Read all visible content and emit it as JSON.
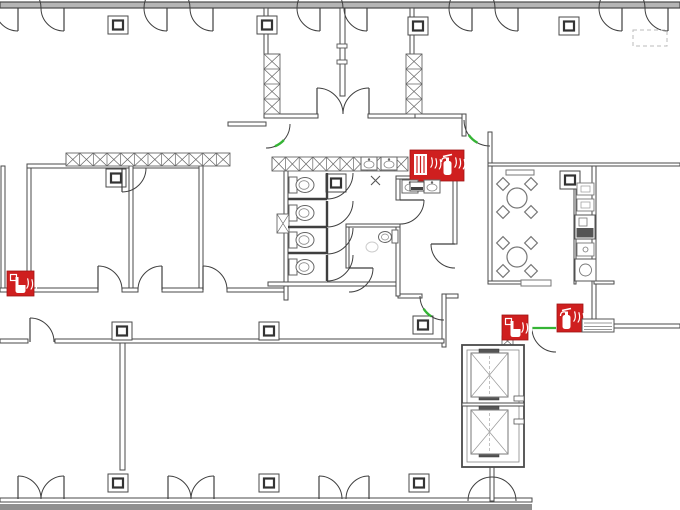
{
  "meta": {
    "drawing_type": "fire-safety-evacuation-floor-plan",
    "canvas": {
      "w": 680,
      "h": 510
    }
  },
  "palette": {
    "wall_stroke": "#4a4a4a",
    "wall_ext_fill": "#b5b5b5",
    "wall_band_fill": "#8f8f8f",
    "thin_fill": "#ffffff",
    "fixture_stroke": "#777777",
    "light_stroke": "#bbbbbb",
    "ghost_stroke": "#cccccc",
    "door_stroke": "#3f3f3f",
    "fire_red": "#cf1f1f",
    "exit_green": "#35b435",
    "dark_fill": "#555555",
    "white": "#ffffff"
  },
  "walls": {
    "exterior": [
      {
        "n": "top-exterior-wall",
        "x": 0,
        "y": 2,
        "w": 680,
        "h": 6,
        "t": "ext"
      },
      {
        "n": "bottom-exterior-wall",
        "x": 0,
        "y": 498,
        "w": 532,
        "h": 4,
        "t": "thin"
      },
      {
        "n": "bottom-exterior-band",
        "x": 0,
        "y": 504,
        "w": 532,
        "h": 6,
        "t": "band"
      }
    ],
    "interior": [
      {
        "n": "left-shaft-west-wall",
        "x": 1,
        "y": 166,
        "w": 4,
        "h": 126
      },
      {
        "n": "left-shaft-east-wall",
        "x": 27,
        "y": 166,
        "w": 4,
        "h": 126
      },
      {
        "n": "rooms-top-wall",
        "x": 27,
        "y": 164,
        "w": 176,
        "h": 4
      },
      {
        "n": "room-divider-a-b",
        "x": 129,
        "y": 166,
        "w": 4,
        "h": 124
      },
      {
        "n": "room-divider-b-bay",
        "x": 199,
        "y": 166,
        "w": 4,
        "h": 124
      },
      {
        "n": "corridor-top-wall-1",
        "x": 0,
        "y": 288,
        "w": 98,
        "h": 4
      },
      {
        "n": "corridor-top-wall-2",
        "x": 122,
        "y": 288,
        "w": 16,
        "h": 4
      },
      {
        "n": "corridor-top-wall-3",
        "x": 162,
        "y": 288,
        "w": 41,
        "h": 4
      },
      {
        "n": "corridor-top-wall-4",
        "x": 227,
        "y": 288,
        "w": 60,
        "h": 4
      },
      {
        "n": "vestibule-left-wall-top",
        "x": 264,
        "y": 8,
        "w": 4,
        "h": 46
      },
      {
        "n": "vestibule-mid-wall",
        "x": 340,
        "y": 8,
        "w": 5,
        "h": 88
      },
      {
        "n": "vestibule-right-wall-top",
        "x": 410,
        "y": 8,
        "w": 4,
        "h": 46
      },
      {
        "n": "vestibule-bottom-wall-left",
        "x": 264,
        "y": 114,
        "w": 54,
        "h": 4
      },
      {
        "n": "vestibule-bottom-wall-right",
        "x": 368,
        "y": 114,
        "w": 47,
        "h": 4
      },
      {
        "n": "hall-wall-y114",
        "x": 415,
        "y": 114,
        "w": 51,
        "h": 4
      },
      {
        "n": "hall-corner-wall",
        "x": 462,
        "y": 114,
        "w": 4,
        "h": 22
      },
      {
        "n": "breakroom-entry-wall",
        "x": 488,
        "y": 132,
        "w": 4,
        "h": 34
      },
      {
        "n": "right-wing-top-wall",
        "x": 488,
        "y": 163,
        "w": 192,
        "h": 3
      },
      {
        "n": "breakroom-left-wall",
        "x": 488,
        "y": 166,
        "w": 4,
        "h": 118
      },
      {
        "n": "breakroom-bottom-wall",
        "x": 488,
        "y": 281,
        "w": 60,
        "h": 3
      },
      {
        "n": "kitchen-right-wall",
        "x": 592,
        "y": 166,
        "w": 4,
        "h": 158
      },
      {
        "n": "kitchen-bottom-wall",
        "x": 594,
        "y": 281,
        "w": 20,
        "h": 3
      },
      {
        "n": "right-lobby-wall",
        "x": 614,
        "y": 324,
        "w": 66,
        "h": 4
      },
      {
        "n": "left-vestibule-west-wall",
        "x": 228,
        "y": 122,
        "w": 38,
        "h": 4
      },
      {
        "n": "toilet-left-wall",
        "x": 284,
        "y": 167,
        "w": 4,
        "h": 133
      },
      {
        "n": "toilet-bottom-wall-left",
        "x": 268,
        "y": 282,
        "w": 130,
        "h": 4
      },
      {
        "n": "toilet-bottom-wall-mid",
        "x": 398,
        "y": 294,
        "w": 24,
        "h": 4
      },
      {
        "n": "toilet-bottom-wall-right",
        "x": 444,
        "y": 294,
        "w": 14,
        "h": 4
      },
      {
        "n": "washroom-top-wall",
        "x": 396,
        "y": 176,
        "w": 62,
        "h": 3
      },
      {
        "n": "washroom-left-wall-upper",
        "x": 396,
        "y": 179,
        "w": 4,
        "h": 21
      },
      {
        "n": "washroom-left-wall-lower",
        "x": 396,
        "y": 224,
        "w": 4,
        "h": 72
      },
      {
        "n": "wc-room-top-wall",
        "x": 346,
        "y": 224,
        "w": 54,
        "h": 3
      },
      {
        "n": "wc-room-left-wall",
        "x": 346,
        "y": 227,
        "w": 3,
        "h": 41
      },
      {
        "n": "washroom-right-wall",
        "x": 453,
        "y": 176,
        "w": 4,
        "h": 68
      },
      {
        "n": "elevator-lobby-left-wall",
        "x": 442,
        "y": 294,
        "w": 4,
        "h": 53
      },
      {
        "n": "corridor-bottom-wall-1",
        "x": 0,
        "y": 339,
        "w": 28,
        "h": 4
      },
      {
        "n": "corridor-bottom-wall-2",
        "x": 55,
        "y": 339,
        "w": 389,
        "h": 4
      },
      {
        "n": "office-partition-wall",
        "x": 120,
        "y": 343,
        "w": 5,
        "h": 127
      },
      {
        "n": "below-shaft-wall",
        "x": 490,
        "y": 465,
        "w": 4,
        "h": 36
      },
      {
        "n": "kitchen-counter-edge",
        "x": 574,
        "y": 178,
        "w": 2,
        "h": 106
      }
    ]
  },
  "elevator": {
    "outer": {
      "x": 462,
      "y": 345,
      "w": 62,
      "h": 122
    },
    "inner": {
      "x": 467,
      "y": 350,
      "w": 52,
      "h": 112
    },
    "divider": {
      "x": 462,
      "y": 403,
      "w": 62,
      "h": 3
    },
    "cars": [
      {
        "x": 471,
        "y": 353,
        "w": 37,
        "h": 44
      },
      {
        "x": 471,
        "y": 410,
        "w": 37,
        "h": 44
      }
    ],
    "mechs": [
      [
        479,
        349,
        20,
        5
      ],
      [
        479,
        395,
        20,
        5
      ],
      [
        479,
        406,
        20,
        5
      ],
      [
        479,
        452,
        20,
        5
      ]
    ],
    "jambs": [
      [
        514,
        396,
        10,
        5
      ],
      [
        514,
        419,
        10,
        5
      ]
    ]
  },
  "hatches": [
    {
      "n": "hatched-wall-left",
      "x": 66,
      "y": 153,
      "w": 164,
      "h": 13,
      "o": "h"
    },
    {
      "n": "hatched-wall-toilet",
      "x": 272,
      "y": 157,
      "w": 136,
      "h": 14,
      "o": "h"
    },
    {
      "n": "hatched-wall-vestibule-left",
      "x": 264,
      "y": 54,
      "w": 16,
      "h": 60,
      "o": "v"
    },
    {
      "n": "hatched-wall-vestibule-right",
      "x": 406,
      "y": 54,
      "w": 16,
      "h": 60,
      "o": "v"
    },
    {
      "n": "hatched-wall-stall",
      "x": 277,
      "y": 214,
      "w": 12,
      "h": 19,
      "o": "v"
    },
    {
      "n": "hatched-wall-lobby-stub",
      "x": 502,
      "y": 336,
      "w": 11,
      "h": 10,
      "o": "v"
    }
  ],
  "columns": [
    [
      118,
      25
    ],
    [
      267,
      25
    ],
    [
      418,
      26
    ],
    [
      569,
      26
    ],
    [
      116,
      178
    ],
    [
      336,
      183
    ],
    [
      570,
      180
    ],
    [
      122,
      331
    ],
    [
      269,
      331
    ],
    [
      423,
      325
    ],
    [
      118,
      483
    ],
    [
      269,
      483
    ],
    [
      419,
      483
    ]
  ],
  "doors": [
    {
      "n": "door-top-1-left",
      "c": [
        18,
        8
      ],
      "r": 23,
      "a1": 90,
      "a2": 360,
      "leaf": true
    },
    {
      "n": "door-top-1-right",
      "c": [
        64,
        8
      ],
      "r": 23,
      "a1": 90,
      "a2": 180,
      "leaf": true
    },
    {
      "n": "door-top-2-left",
      "c": [
        167,
        8
      ],
      "r": 23,
      "a1": 90,
      "a2": 360,
      "leaf": true
    },
    {
      "n": "door-top-2-right",
      "c": [
        213,
        8
      ],
      "r": 23,
      "a1": 90,
      "a2": 180,
      "leaf": true
    },
    {
      "n": "door-top-3-left",
      "c": [
        320,
        8
      ],
      "r": 23,
      "a1": 90,
      "a2": 360,
      "leaf": true
    },
    {
      "n": "door-top-3-right",
      "c": [
        367,
        8
      ],
      "r": 23,
      "a1": 90,
      "a2": 180,
      "leaf": true
    },
    {
      "n": "door-top-4-left",
      "c": [
        472,
        8
      ],
      "r": 23,
      "a1": 90,
      "a2": 360,
      "leaf": true
    },
    {
      "n": "door-top-4-right",
      "c": [
        518,
        8
      ],
      "r": 23,
      "a1": 90,
      "a2": 180,
      "leaf": true
    },
    {
      "n": "door-top-5-left",
      "c": [
        622,
        8
      ],
      "r": 23,
      "a1": 90,
      "a2": 360,
      "leaf": true
    },
    {
      "n": "door-top-5-right",
      "c": [
        668,
        8
      ],
      "r": 23,
      "a1": 90,
      "a2": 180,
      "leaf": true
    },
    {
      "n": "door-room-a-top",
      "c": [
        122,
        168
      ],
      "r": 24,
      "a1": 90,
      "a2": 0,
      "leaf": true
    },
    {
      "n": "door-room-a",
      "c": [
        98,
        290
      ],
      "r": 24,
      "a1": 270,
      "a2": 360,
      "leaf": true
    },
    {
      "n": "door-room-b",
      "c": [
        162,
        290
      ],
      "r": 24,
      "a1": 270,
      "a2": 180,
      "leaf": true
    },
    {
      "n": "door-bay",
      "c": [
        203,
        290
      ],
      "r": 24,
      "a1": 270,
      "a2": 360,
      "leaf": true
    },
    {
      "n": "door-corridor-office",
      "c": [
        30,
        342
      ],
      "r": 24,
      "a1": 270,
      "a2": 360,
      "leaf": true
    },
    {
      "n": "door-vestibule-left-leaf",
      "c": [
        317,
        114
      ],
      "r": 26,
      "a1": 270,
      "a2": 360,
      "leaf": true
    },
    {
      "n": "door-vestibule-right-leaf",
      "c": [
        369,
        114
      ],
      "r": 26,
      "a1": 270,
      "a2": 180,
      "leaf": true
    },
    {
      "n": "door-stall-1",
      "c": [
        327,
        173
      ],
      "r": 26,
      "a1": 90,
      "a2": 0,
      "leaf": true,
      "thick": true
    },
    {
      "n": "door-stall-2",
      "c": [
        327,
        201
      ],
      "r": 26,
      "a1": 90,
      "a2": 0,
      "leaf": true,
      "thick": true
    },
    {
      "n": "door-stall-3",
      "c": [
        327,
        228
      ],
      "r": 26,
      "a1": 90,
      "a2": 0,
      "leaf": true,
      "thick": true
    },
    {
      "n": "door-stall-4",
      "c": [
        327,
        255
      ],
      "r": 26,
      "a1": 90,
      "a2": 0,
      "leaf": true,
      "thick": true
    },
    {
      "n": "door-washroom",
      "c": [
        400,
        200
      ],
      "r": 24,
      "a1": 0,
      "a2": 90,
      "leaf": true
    },
    {
      "n": "door-wc-room",
      "c": [
        349,
        268
      ],
      "r": 24,
      "a1": 0,
      "a2": 90,
      "leaf": true
    },
    {
      "n": "door-washroom-right",
      "c": [
        455,
        244
      ],
      "r": 24,
      "a1": 180,
      "a2": 90,
      "leaf": true
    },
    {
      "n": "exit-door-left-vestibule",
      "c": [
        266,
        124
      ],
      "r": 24,
      "a1": 0,
      "a2": 90,
      "green": "tip",
      "tip": 55
    },
    {
      "n": "exit-door-breakroom-entry",
      "c": [
        490,
        120
      ],
      "r": 26,
      "a1": 90,
      "a2": 180,
      "green": "tip",
      "tip": 132
    },
    {
      "n": "exit-door-toilet-corridor",
      "c": [
        444,
        296
      ],
      "r": 24,
      "a1": 90,
      "a2": 180,
      "green": "tip",
      "tip": 135
    },
    {
      "n": "exit-door-elevator-lobby",
      "c": [
        556,
        328
      ],
      "r": 24,
      "a1": 180,
      "a2": 90,
      "leaf": true,
      "green": "leaf"
    },
    {
      "n": "door-shaft-exit",
      "c": [
        492,
        501
      ],
      "r": 24,
      "a1": 180,
      "a2": 360
    },
    {
      "n": "door-bottom-1-left",
      "c": [
        18,
        499
      ],
      "r": 23,
      "a1": 270,
      "a2": 360,
      "leaf": true
    },
    {
      "n": "door-bottom-1-right",
      "c": [
        64,
        499
      ],
      "r": 23,
      "a1": 270,
      "a2": 180,
      "leaf": true
    },
    {
      "n": "door-bottom-2-left",
      "c": [
        168,
        499
      ],
      "r": 23,
      "a1": 270,
      "a2": 360,
      "leaf": true
    },
    {
      "n": "door-bottom-2-right",
      "c": [
        214,
        499
      ],
      "r": 23,
      "a1": 270,
      "a2": 180,
      "leaf": true
    },
    {
      "n": "door-bottom-3-left",
      "c": [
        319,
        499
      ],
      "r": 23,
      "a1": 270,
      "a2": 360,
      "leaf": true
    },
    {
      "n": "door-bottom-3-right",
      "c": [
        369,
        499
      ],
      "r": 23,
      "a1": 270,
      "a2": 180,
      "leaf": true
    }
  ],
  "fire_equipment": [
    {
      "n": "fire-hose-reel-extinguisher-panel",
      "x": 410,
      "y": 150,
      "w": 54,
      "h": 31,
      "icons": [
        "hose",
        "flames",
        "extinguisher",
        "flames"
      ]
    },
    {
      "n": "manual-call-point-extinguisher-marker",
      "x": 7,
      "y": 271,
      "w": 27,
      "h": 25,
      "icons": [
        "callpoint",
        "flames"
      ]
    },
    {
      "n": "manual-call-point-marker",
      "x": 502,
      "y": 315,
      "w": 26,
      "h": 25,
      "icons": [
        "callpoint",
        "flames"
      ]
    },
    {
      "n": "fire-extinguisher-marker",
      "x": 557,
      "y": 304,
      "w": 26,
      "h": 28,
      "icons": [
        "extinguisher",
        "flames"
      ]
    }
  ],
  "fixtures": [
    {
      "t": "toilet",
      "n": "toilet-fixture",
      "y": 185
    },
    {
      "t": "toilet",
      "n": "toilet-fixture",
      "y": 213
    },
    {
      "t": "toilet",
      "n": "toilet-fixture",
      "y": 240
    },
    {
      "t": "toilet",
      "n": "toilet-fixture",
      "y": 267
    },
    {
      "t": "bar",
      "n": "stall-divider",
      "x1": 288,
      "y1": 199,
      "x2": 327,
      "y2": 199
    },
    {
      "t": "bar",
      "n": "stall-divider",
      "x1": 288,
      "y1": 227,
      "x2": 327,
      "y2": 227
    },
    {
      "t": "bar",
      "n": "stall-divider",
      "x1": 288,
      "y1": 253,
      "x2": 327,
      "y2": 253
    },
    {
      "t": "sink",
      "n": "sink-fixture",
      "x": 361,
      "y": 157
    },
    {
      "t": "sink",
      "n": "sink-fixture",
      "x": 381,
      "y": 157
    },
    {
      "t": "sink",
      "n": "sink-fixture",
      "x": 402,
      "y": 180
    },
    {
      "t": "sink",
      "n": "sink-fixture",
      "x": 424,
      "y": 180
    },
    {
      "t": "xmark",
      "n": "floor-x-mark",
      "x": 371,
      "y": 176,
      "s": 9
    },
    {
      "t": "wcside",
      "n": "wall-hung-toilet",
      "tank": [
        392,
        230,
        6,
        13
      ],
      "bowl": [
        385,
        237
      ]
    },
    {
      "t": "ghost",
      "n": "ghost-fixture",
      "x": 372,
      "y": 247
    },
    {
      "t": "table",
      "n": "round-table-with-chairs",
      "x": 517,
      "y": 198
    },
    {
      "t": "table",
      "n": "round-table-with-chairs",
      "x": 517,
      "y": 257
    },
    {
      "t": "rect",
      "n": "bench",
      "x": 506,
      "y": 170,
      "w": 28,
      "h": 5
    },
    {
      "t": "rect",
      "n": "bench",
      "x": 521,
      "y": 280,
      "w": 30,
      "h": 6
    },
    {
      "t": "kbox",
      "n": "kitchen-item",
      "x": 577,
      "y": 183,
      "w": 17,
      "h": 12
    },
    {
      "t": "kbox",
      "n": "kitchen-item",
      "x": 577,
      "y": 199,
      "w": 17,
      "h": 12
    },
    {
      "t": "stove",
      "n": "kitchen-stove",
      "x": 575,
      "y": 215,
      "w": 20,
      "h": 24
    },
    {
      "t": "kcirc",
      "n": "kitchen-item",
      "x": 577,
      "y": 243,
      "w": 17,
      "h": 13
    },
    {
      "t": "washer",
      "n": "kitchen-sink-unit",
      "x": 575,
      "y": 259,
      "w": 21,
      "h": 22
    },
    {
      "t": "grille",
      "n": "vent-grille-wall",
      "x": 582,
      "y": 319,
      "w": 32,
      "h": 13
    },
    {
      "t": "dash",
      "n": "closet-outline",
      "x": 633,
      "y": 30,
      "w": 34,
      "h": 16
    },
    {
      "t": "jamb",
      "n": "door-jamb",
      "x": 337,
      "y": 44,
      "w": 10,
      "h": 4
    },
    {
      "t": "jamb",
      "n": "door-jamb",
      "x": 337,
      "y": 60,
      "w": 10,
      "h": 4
    },
    {
      "t": "subbox",
      "n": "panel-sub-box",
      "x": 410,
      "y": 182,
      "w": 14,
      "h": 9
    }
  ]
}
